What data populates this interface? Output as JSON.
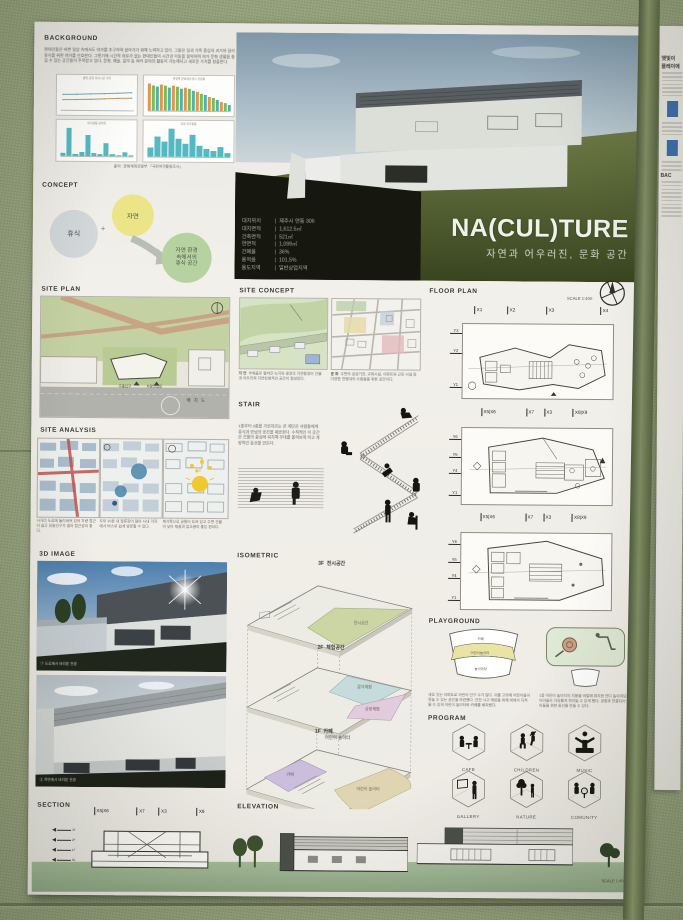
{
  "wall": {
    "color": "#94a07b",
    "column_color": "#6f7b57"
  },
  "poster": {
    "background": {
      "title": "BACKGROUND",
      "paragraph": "현대인들은 바쁜 일상 속에서도 여가를 추구하며 살아가기 위해 노력하고 있다. 그들은 일과 가족 중심의 과거와 달리 휴식을 위한 여가를 선호한다. 그렇기에 시간적 여유가 없는 현대인들이 시간과 이동을 절약하며 여가 문화 생활을 즐길 수 있는 공간들이 주목받고 있다. 문화, 예술, 음악 등 여러 분야의 활동이 가능해지고 새로운 가치를 창출한다.",
      "source": "출처 : 문화체육관광부 「국민여가활동조사」"
    },
    "concept": {
      "title": "CONCEPT",
      "rest": "휴식",
      "plus": "+",
      "nature": "자연",
      "result_lines": [
        "자연 환경",
        "속에서의",
        "휴식 공간"
      ]
    },
    "hero": {
      "title": "NA(CUL)TURE",
      "subtitle": "자연과 어우러진, 문화 공간",
      "specs": [
        {
          "label": "대지위치",
          "value": "제주시 연동 306"
        },
        {
          "label": "대지면적",
          "value": "1,612.5㎡"
        },
        {
          "label": "건축면적",
          "value": "521㎡"
        },
        {
          "label": "연면적",
          "value": "1,099㎡"
        },
        {
          "label": "건폐율",
          "value": "36%"
        },
        {
          "label": "용적률",
          "value": "101.5%"
        },
        {
          "label": "용도지역",
          "value": "일반상업지역"
        }
      ]
    },
    "site_plan": {
      "title": "SITE PLAN",
      "labels": {
        "main_entrance": "주출입구",
        "vehicle_entrance": "차량진입로",
        "caption": "배 치 도"
      }
    },
    "site_concept": {
      "title": "SITE CONCEPT",
      "items": [
        {
          "heading": "자 연",
          "text": "부채꼴로 펼쳐진 녹지와 광장의 자연환경이 건물과 어우러져 자연친화적인 공간이 형성된다."
        },
        {
          "heading": "문 화",
          "text": "주변의 공공기관, 교육시설, 아파트와 근린 시설 등 다양한 연령대의 사람들을 위한 공간이다."
        }
      ]
    },
    "stair": {
      "title": "STAIR",
      "paragraph": "1층부터 3층을 가로지르는 큰 계단은 사람들에게 휴식과 만남의 공간을 제공한다. 수직적인 이 공간은 건물의 중심에 위치해 무대를 올려보게 하고 개방적인 동선을 만든다."
    },
    "site_analysis": {
      "title": "SITE ANALYSIS",
      "items": [
        {
          "text": "사거리 도로에 둘러싸여 있어 차량 접근이 쉽고 유동인구가 많아 접근성이 좋다."
        },
        {
          "text": "도보 10분 내 정류장이 많아 시내 각지에서 버스로 쉽게 방문할 수 있다."
        },
        {
          "text": "북서쪽으로 공원이 트여 있고 주변 건물이 낮아 채광과 일조량이 좋은 편이다."
        }
      ]
    },
    "three_d": {
      "title": "3D IMAGE",
      "captions": [
        "① 도로에서 바라본 전경",
        "② 측면에서 바라본 전경"
      ]
    },
    "isometric": {
      "title": "ISOMETRIC",
      "floors": [
        {
          "tag": "3F",
          "name": "전시공간",
          "zone": "전시공간"
        },
        {
          "tag": "2F",
          "name": "체험공간",
          "zone_a": "음악체험",
          "zone_b": "공방체험"
        },
        {
          "tag": "1F",
          "name": "카페",
          "name2": "어린이 놀이터",
          "zone_a": "카페",
          "zone_b": "어린이 놀이터"
        }
      ]
    },
    "floor_plan": {
      "title": "FLOOR PLAN",
      "scale": "SCALE  1:400",
      "plan1": {
        "top": [
          "X1",
          "X2",
          "X3",
          "X4"
        ],
        "left": [
          "Y3",
          "Y2",
          "Y1"
        ]
      },
      "plan2": {
        "top": [
          "X5|X6",
          "X7",
          "X3",
          "X8|X9"
        ],
        "left": [
          "Y6",
          "Y5",
          "Y4",
          "Y1"
        ]
      },
      "plan3": {
        "top": [
          "X5|X6",
          "X7",
          "X3",
          "X8|X9"
        ],
        "left": [
          "Y6",
          "Y5",
          "Y4",
          "Y1"
        ]
      }
    },
    "playground": {
      "title": "PLAYGROUND",
      "fan_labels": [
        "카페",
        "어린이놀이터",
        "놀이마당"
      ],
      "captions": [
        "새로 짓는 아파트로 어린이 인구 수가 많다. 이를 고려해 어린이들이 뛰놀 수 있는 공간을 마련했다. 안전 사고 예방을 위해 밖에서 지켜볼 수 있게 어린이 놀이터와 카페를 배치했다.",
        "1층 어린이 놀이터의 지붕을 비탈에 위치한 잔디 놀이마당과 연결해 아이들이 자유롭게 뛰어놀 수 있게 했다. 공원과 연결되어 있는 어린이들을 위한 동선을 만들 수 있다."
      ]
    },
    "program": {
      "title": "PROGRAM",
      "items": [
        {
          "label": "CAFE"
        },
        {
          "label": "CHILDREN"
        },
        {
          "label": "MUSIC"
        },
        {
          "label": "GALLERY"
        },
        {
          "label": "NATURE"
        },
        {
          "label": "COMUNITY"
        }
      ]
    },
    "section": {
      "title": "SECTION",
      "grid": [
        "X5|X6",
        "X7",
        "X3",
        "X9"
      ],
      "levels": [
        {
          "label": "3F"
        },
        {
          "label": "2F"
        },
        {
          "label": "1F"
        },
        {
          "label": "GL"
        }
      ]
    },
    "elevation": {
      "title": "ELEVATION",
      "scale": "SCALE  1:400"
    }
  },
  "neighbor": {
    "fragments": [
      "햇빛이",
      "플레이에",
      "BAC"
    ]
  },
  "chart_data": [
    {
      "id": "leisure-time-trend",
      "type": "line",
      "title": "평일·휴일 여가시간 추이",
      "x": [
        "'16",
        "'17",
        "'18",
        "'19",
        "'20",
        "'21"
      ],
      "series": [
        {
          "name": "휴일",
          "color": "#7ca6b8",
          "values": [
            5.0,
            5.1,
            5.3,
            5.4,
            5.6,
            5.8
          ]
        },
        {
          "name": "평일",
          "color": "#c59a63",
          "values": [
            3.1,
            3.2,
            3.3,
            3.5,
            3.7,
            3.8
          ]
        }
      ],
      "xlabel": "",
      "ylabel": "시간",
      "ylim": [
        0,
        8
      ]
    },
    {
      "id": "culture-attendance-by-age",
      "type": "bar",
      "title": "연령별 문화예술행사 관람률",
      "categories": [
        "10대",
        "20대",
        "30대",
        "40대",
        "50대",
        "60대",
        "70대"
      ],
      "series": [
        {
          "name": "2019",
          "color": "#e0964f",
          "values": [
            90,
            88,
            85,
            78,
            65,
            48,
            30
          ]
        },
        {
          "name": "2020",
          "color": "#7fba5a",
          "values": [
            85,
            83,
            80,
            72,
            58,
            42,
            25
          ]
        },
        {
          "name": "2021",
          "color": "#4fb3a9",
          "values": [
            80,
            78,
            74,
            66,
            52,
            38,
            22
          ]
        }
      ],
      "xlabel": "",
      "ylabel": "%"
    },
    {
      "id": "leisure-activity-rate",
      "type": "bar",
      "title": "여가활동 참여율",
      "color": "#55b9c3",
      "categories": [
        "TV시청",
        "산책",
        "게임",
        "쇼핑",
        "휴식",
        "운동",
        "독서",
        "관광",
        "취미",
        "사교",
        "문화관람",
        "기타"
      ],
      "values": [
        6,
        64,
        5,
        10,
        48,
        6,
        4,
        30,
        4,
        3,
        8,
        3
      ],
      "xlabel": "",
      "ylabel": "%"
    },
    {
      "id": "desired-leisure-activity",
      "type": "bar",
      "title": "희망 여가활동",
      "color": "#55b9c3",
      "categories": [
        "TV시청",
        "산책",
        "게임",
        "쇼핑",
        "휴식",
        "운동",
        "독서",
        "관광",
        "취미",
        "사교",
        "문화관람",
        "기타"
      ],
      "values": [
        18,
        42,
        30,
        58,
        38,
        28,
        46,
        22,
        16,
        12,
        20,
        8
      ],
      "xlabel": "",
      "ylabel": "%"
    }
  ]
}
